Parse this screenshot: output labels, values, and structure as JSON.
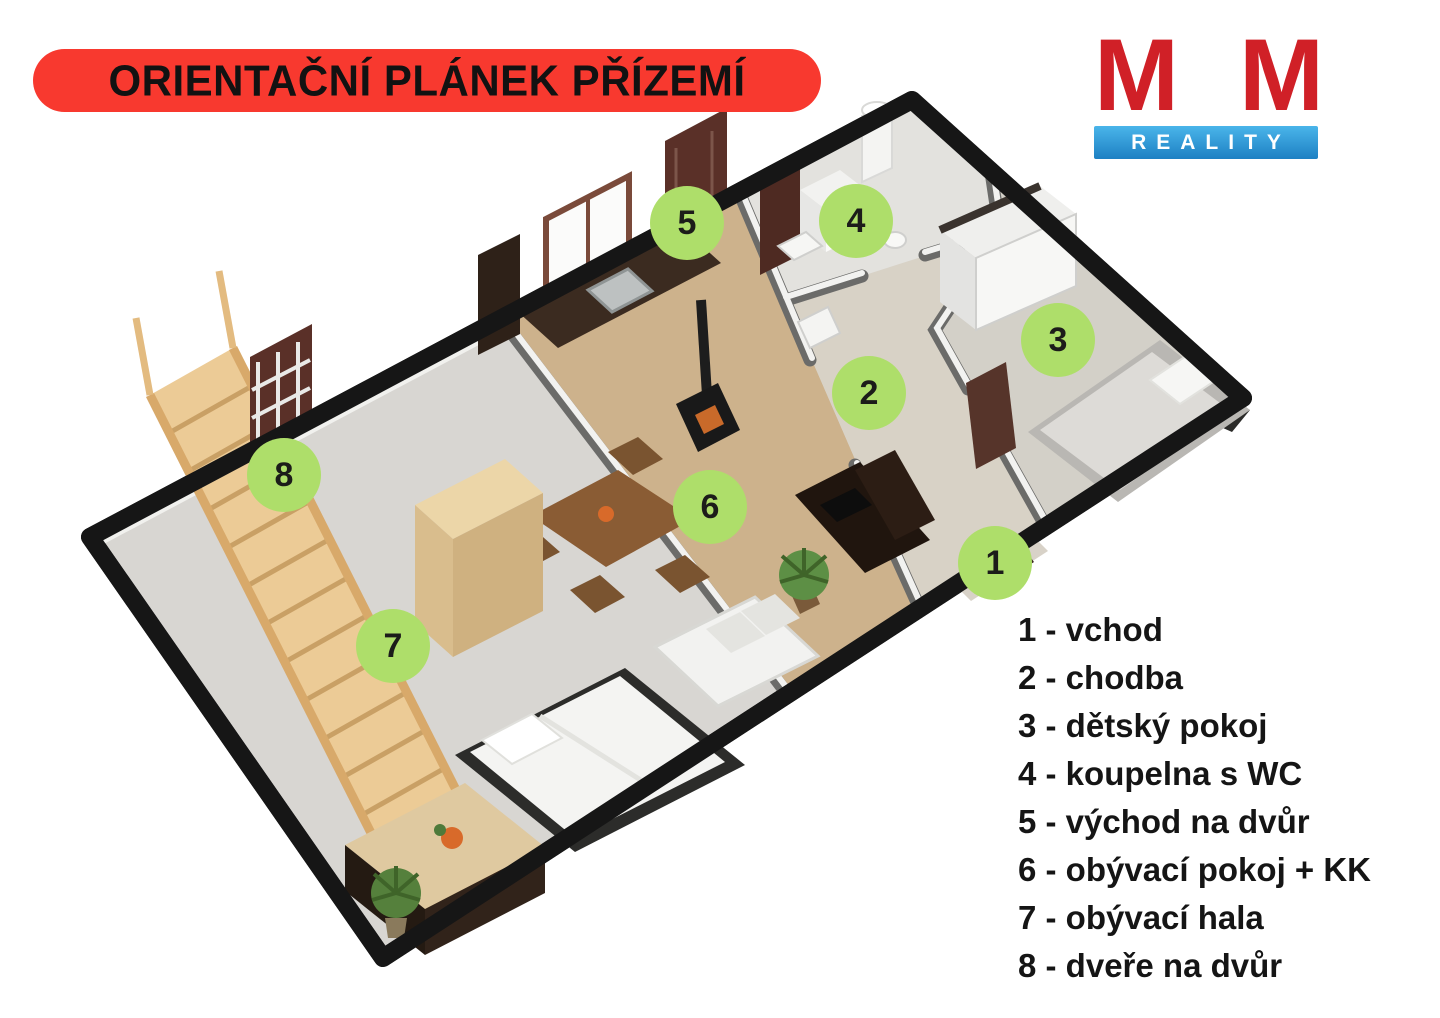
{
  "colors": {
    "banner_red": "#f8392f",
    "logo_red": "#d02027",
    "logo_blue_1": "#4ab5ea",
    "logo_blue_2": "#1d80c3",
    "marker_green": "#aede6a"
  },
  "banner": {
    "title": "ORIENTAČNÍ PLÁNEK PŘÍZEMÍ"
  },
  "logo": {
    "m_left": "M",
    "amp": "&",
    "m_right": "M",
    "reality": "REALITY"
  },
  "legend": {
    "items": [
      {
        "number": "1",
        "label": "vchod",
        "text": "1 - vchod"
      },
      {
        "number": "2",
        "label": "chodba",
        "text": "2 - chodba"
      },
      {
        "number": "3",
        "label": "dětský pokoj",
        "text": "3 - dětský pokoj"
      },
      {
        "number": "4",
        "label": "koupelna s WC",
        "text": "4 - koupelna s WC"
      },
      {
        "number": "5",
        "label": "východ na dvůr",
        "text": "5 - východ na dvůr"
      },
      {
        "number": "6",
        "label": "obývací pokoj + KK",
        "text": "6 - obývací pokoj + KK"
      },
      {
        "number": "7",
        "label": "obývací hala",
        "text": "7 - obývací hala"
      },
      {
        "number": "8",
        "label": "dveře na dvůr",
        "text": "8 - dveře na dvůr"
      }
    ]
  },
  "plan": {
    "markers": [
      {
        "number": "1",
        "x": 995,
        "y": 563
      },
      {
        "number": "2",
        "x": 869,
        "y": 393
      },
      {
        "number": "3",
        "x": 1058,
        "y": 340
      },
      {
        "number": "4",
        "x": 856,
        "y": 221
      },
      {
        "number": "5",
        "x": 687,
        "y": 223
      },
      {
        "number": "6",
        "x": 710,
        "y": 507
      },
      {
        "number": "7",
        "x": 393,
        "y": 646
      },
      {
        "number": "8",
        "x": 284,
        "y": 475
      }
    ]
  }
}
